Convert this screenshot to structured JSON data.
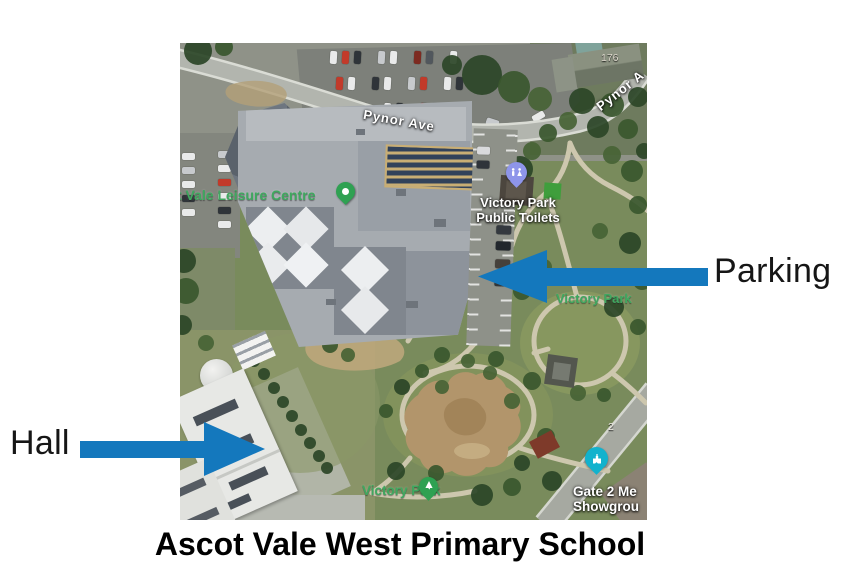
{
  "figure": {
    "caption": "Ascot Vale West Primary School"
  },
  "annotations": {
    "parking": {
      "label": "Parking"
    },
    "hall": {
      "label": "Hall"
    },
    "arrow_color": "#1478bd",
    "text_color": "#161616"
  },
  "map": {
    "street_labels": {
      "pynor_ave": "Pynor Ave",
      "pynor_ave_corner": "Pynor A"
    },
    "house_numbers": {
      "top_right": "176",
      "roadside": "2"
    },
    "poi": {
      "leisure_centre": {
        "label": "t Vale Leisure Centre",
        "pin_color": "#2fa152"
      },
      "public_toilets": {
        "line1": "Victory Park",
        "line2": "Public Toilets",
        "pin_color": "#8e95ea"
      },
      "victory_park_upper": {
        "label": "Victory Park"
      },
      "victory_park_lower": {
        "label": "Victory Park",
        "pin_color": "#2fa152"
      },
      "showgrounds_gate": {
        "line1": "Gate 2 Me",
        "line2": "Showgrou",
        "pin_color": "#12b2cd"
      }
    },
    "label_green": "#3fa85f"
  }
}
